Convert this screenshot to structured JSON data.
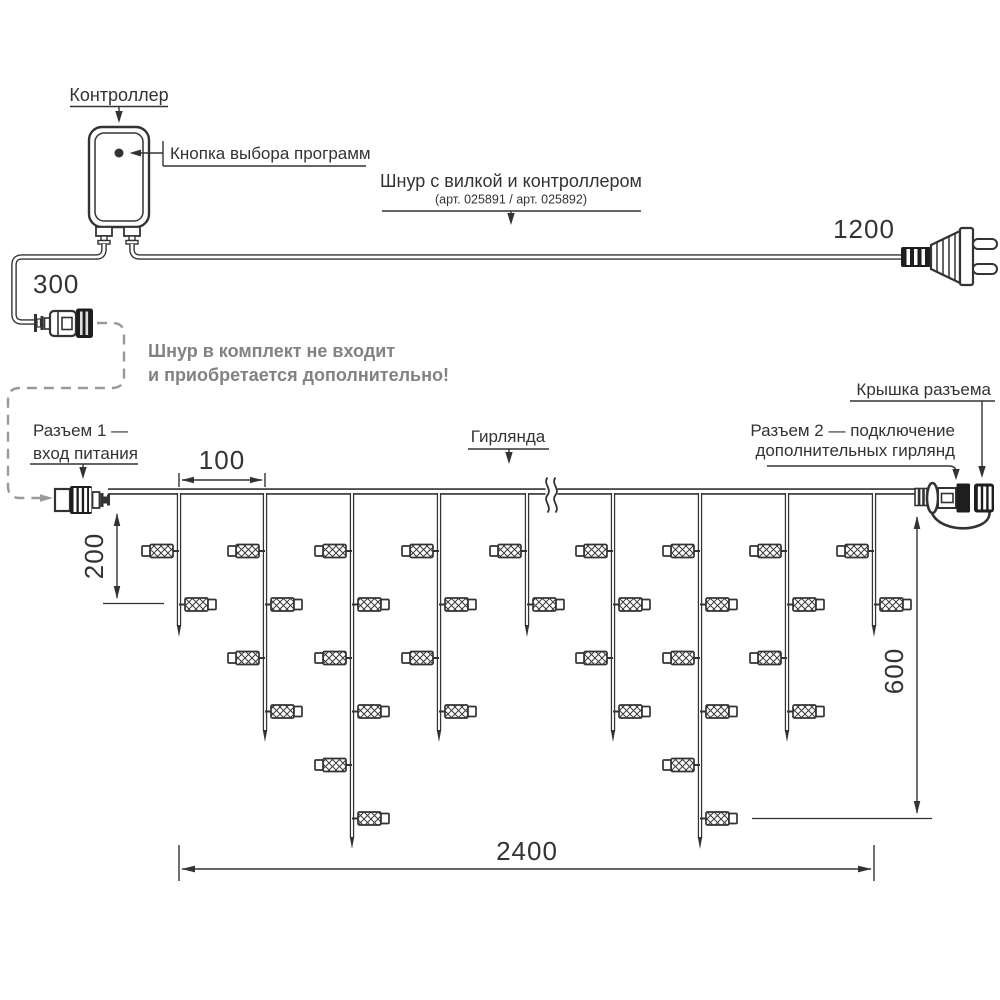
{
  "labels": {
    "controller": "Контроллер",
    "program_button": "Кнопка выбора программ",
    "cord_title": "Шнур с вилкой и контроллером",
    "cord_art": "(арт. 025891  /  арт. 025892)",
    "connector1_line1": "Разъем 1 —",
    "connector1_line2": "вход питания",
    "garland": "Гирлянда",
    "connector2_line1": "Разъем 2 — подключение",
    "connector2_line2": "дополнительных гирлянд",
    "cap": "Крышка разъема"
  },
  "note": {
    "line1": "Шнур в комплект не входит",
    "line2": "и приобретается дополнительно!"
  },
  "dimensions": {
    "cord_plug": "1200",
    "cord_input": "300",
    "drop_spacing": "100",
    "drop_short": "200",
    "drop_long": "600",
    "garland_width": "2400"
  },
  "garland": {
    "drop_xs": [
      179,
      265,
      352,
      439,
      527,
      613,
      700,
      787,
      874
    ],
    "bulb_counts": [
      2,
      4,
      6,
      4,
      2,
      4,
      6,
      4,
      2
    ],
    "level_y0": 551,
    "level_dy": 53.5,
    "tip_y": {
      "2": 637,
      "4": 742,
      "6": 849
    },
    "wire_y": 491.5,
    "break_x": 551
  },
  "colors": {
    "line": "#333333",
    "note_text": "#828282",
    "dashed_route": "#999999"
  }
}
